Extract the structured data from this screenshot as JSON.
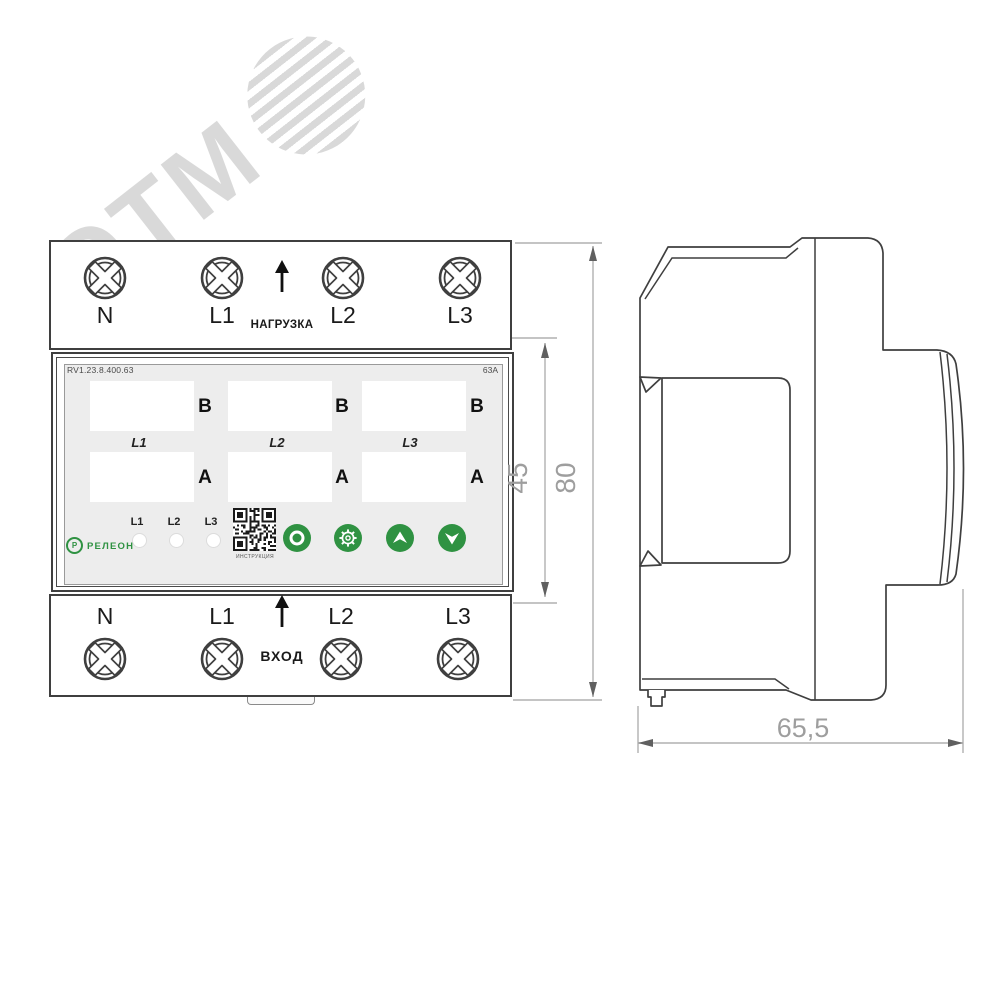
{
  "watermark": {
    "text": "ЭТМ"
  },
  "front_view": {
    "load_section": {
      "terminals": [
        "N",
        "L1",
        "L2",
        "L3"
      ],
      "direction_label": "НАГРУЗКА"
    },
    "display": {
      "model": "RV1.23.8.400.63",
      "rating": "63A",
      "phase_labels": [
        "L1",
        "L2",
        "L3"
      ],
      "voltage_unit": "В",
      "current_unit": "А",
      "led_labels": [
        "L1",
        "L2",
        "L3"
      ],
      "qr_label": "ИНСТРУКЦИЯ",
      "brand": "РЕЛЕОН",
      "brand_mark": "Р",
      "buttons": [
        "power",
        "settings",
        "up",
        "down"
      ]
    },
    "input_section": {
      "terminals": [
        "N",
        "L1",
        "L2",
        "L3"
      ],
      "direction_label": "ВХОД"
    }
  },
  "dimensions": {
    "front_height": "45",
    "total_height": "80",
    "depth": "65,5"
  },
  "colors": {
    "accent_green": "#2f9242",
    "outline": "#3f3f3f",
    "dim_line": "#b0b0b0",
    "dim_text": "#9e9e9e",
    "panel_bg": "#ededed"
  }
}
